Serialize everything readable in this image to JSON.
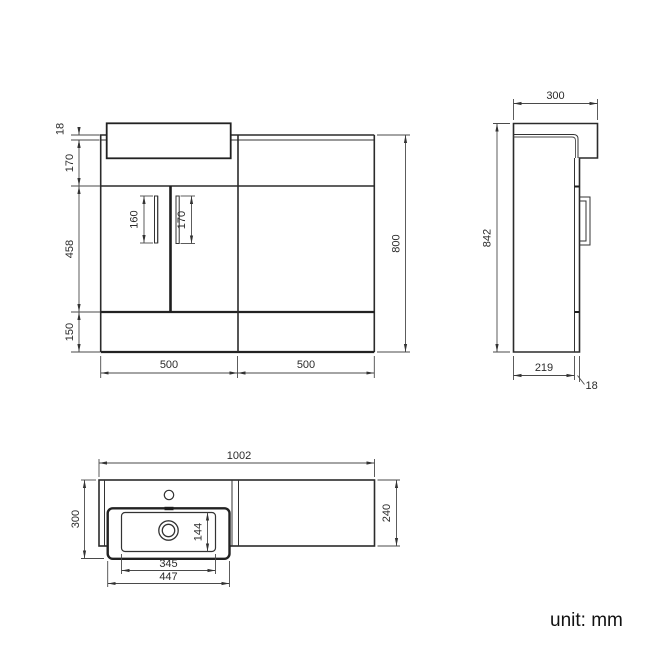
{
  "front_view": {
    "worktop_thickness": "18",
    "top_section_height": "170",
    "door_section_height": "458",
    "plinth_height": "150",
    "total_height": "800",
    "left_width": "500",
    "right_width": "500",
    "left_handle_length": "160",
    "right_handle_length": "170"
  },
  "side_view": {
    "depth": "300",
    "height": "842",
    "body_depth": "219",
    "door_offset": "18"
  },
  "plan_view": {
    "width": "1002",
    "depth": "300",
    "right_depth": "240",
    "basin_bowl_depth": "144",
    "basin_bowl_width": "345",
    "basin_width": "447"
  },
  "footer": {
    "unit_label": "unit: mm"
  },
  "colors": {
    "line": "#333333",
    "background": "#ffffff"
  }
}
